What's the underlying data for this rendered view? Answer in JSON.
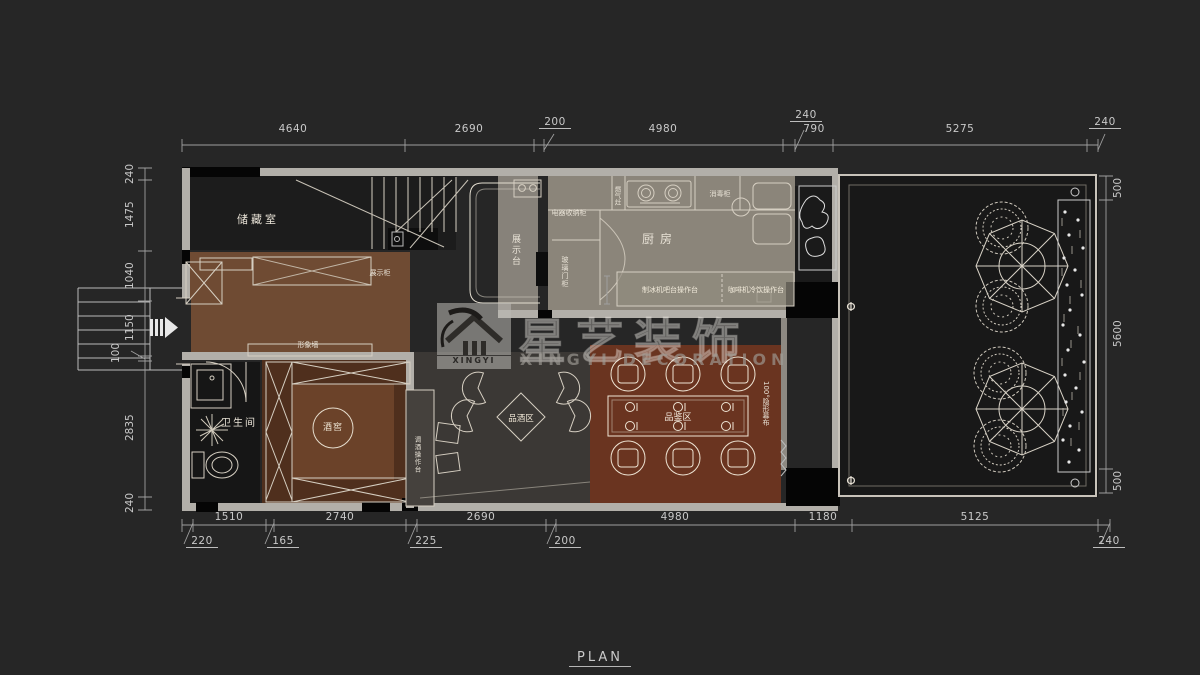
{
  "plan_label": "PLAN",
  "watermark": {
    "brand_cn": "星艺装饰",
    "brand_en": "XINGYI DECORATION",
    "logo_text": "XINGYI"
  },
  "rooms": {
    "storage": "储藏室",
    "kitchen": "厨房",
    "bathroom": "卫生间",
    "wine_cellar": "酒窖",
    "wine_bar_zone": "品酒区",
    "tasting_zone": "品鉴区"
  },
  "annotations": {
    "display_cabinet": "展示柜",
    "feature_wall": "形象墙",
    "display_counter": "展示台",
    "appliance_cabinet": "电器收纳柜",
    "glass_door_cabinet": "玻璃门柜",
    "gas_stove": "燃气灶",
    "disinfection_cabinet": "消毒柜",
    "ice_maker_counter": "制冰机吧台操作台",
    "coffee_counter": "咖啡机冷饮操作台",
    "bar_counter": "调酒操作台",
    "hidden_screen": "100°隐形幕布",
    "phi_marker": "Φ"
  },
  "dimensions": {
    "top": [
      "4640",
      "2690",
      "200",
      "4980",
      "240",
      "790",
      "5275",
      "240"
    ],
    "left": [
      "240",
      "1475",
      "1040",
      "1150",
      "100",
      "2835",
      "240"
    ],
    "right": [
      "500",
      "5600",
      "500"
    ],
    "bottom": [
      "1510",
      "2740",
      "2690",
      "4980",
      "1180",
      "5125"
    ],
    "bottom_sub": [
      "220",
      "165",
      "225",
      "200",
      "240"
    ]
  },
  "colors": {
    "background": "#262626",
    "wall": "#b2afa9",
    "kitchen_floor": "#8b857a",
    "feature_room_floor": "#6f4b33",
    "wine_cellar_floor": "#4f2f1d",
    "tasting_floor": "#6a3420",
    "bar_floor": "#3b3835",
    "dark_room": "#1b1b1b",
    "linework": "#d6cfc2",
    "dimension_text": "#c9c9c9"
  }
}
